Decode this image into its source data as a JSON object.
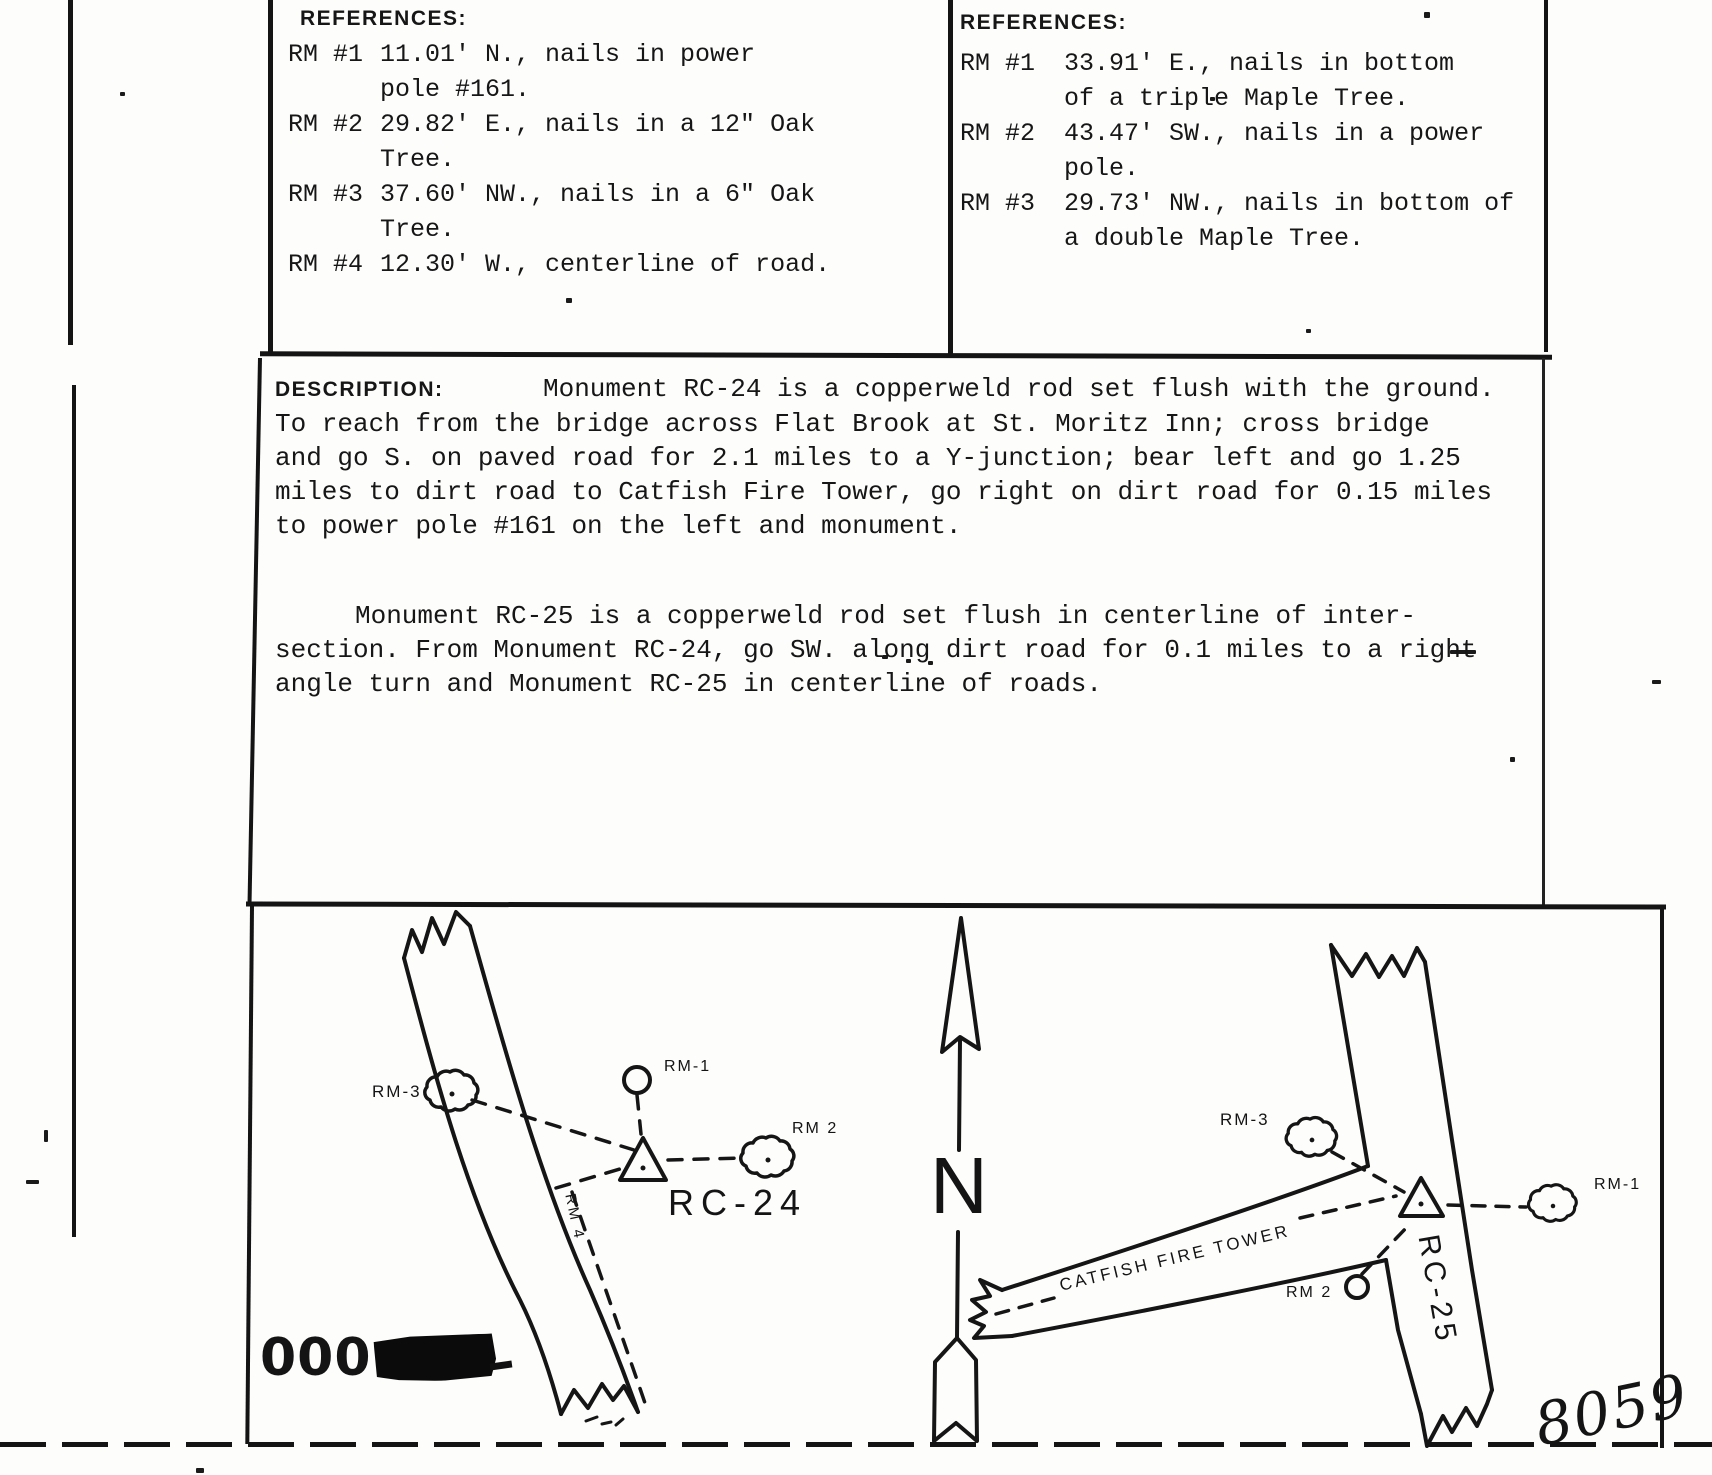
{
  "references_left": {
    "heading": "REFERENCES:",
    "items": [
      {
        "label": "RM #1",
        "line1": "11.01' N., nails in power",
        "line2": "pole #161."
      },
      {
        "label": "RM #2",
        "line1": "29.82' E., nails in a 12\" Oak",
        "line2": "Tree."
      },
      {
        "label": "RM #3",
        "line1": "37.60' NW., nails in a 6\" Oak",
        "line2": "Tree."
      },
      {
        "label": "RM #4",
        "line1": "12.30' W., centerline of road."
      }
    ]
  },
  "references_right": {
    "heading": "REFERENCES:",
    "items": [
      {
        "label": "RM #1",
        "line1": "33.91' E., nails in bottom",
        "line2": "of a triple Maple Tree."
      },
      {
        "label": "RM #2",
        "line1": "43.47' SW., nails in a power",
        "line2": "pole."
      },
      {
        "label": "RM #3",
        "line1": "29.73' NW., nails in bottom of",
        "line2": "a double Maple Tree."
      }
    ]
  },
  "description": {
    "heading": "DESCRIPTION:",
    "p1_lines": [
      "Monument RC-24 is a copperweld rod set flush with the ground.",
      "To reach from the bridge across Flat Brook at St. Moritz Inn; cross bridge",
      "and go S. on paved road for 2.1 miles to a Y-junction; bear left and go 1.25",
      "miles to dirt road to Catfish Fire Tower, go right on dirt road for 0.15 miles",
      "to power pole #161 on the left and monument."
    ],
    "p2_lines": [
      "Monument RC-25 is a copperweld rod set flush in centerline of inter-",
      "section.  From Monument RC-24, go SW. along dirt road for 0.1 miles to a right",
      "angle turn and Monument RC-25 in centerline of roads."
    ]
  },
  "sketch_left": {
    "rm3": "RM-3",
    "rm1": "RM-1",
    "rm2": "RM 2",
    "rm4": "RM 4",
    "monument": "RC-24"
  },
  "north_arrow": {
    "letter": "N"
  },
  "sketch_right": {
    "rm3": "RM-3",
    "rm1": "RM-1",
    "rm2": "RM 2",
    "monument": "RC-25",
    "road_label": "CATFISH FIRE TOWER"
  },
  "stamps": {
    "serial": "000",
    "page_number": "8059"
  }
}
